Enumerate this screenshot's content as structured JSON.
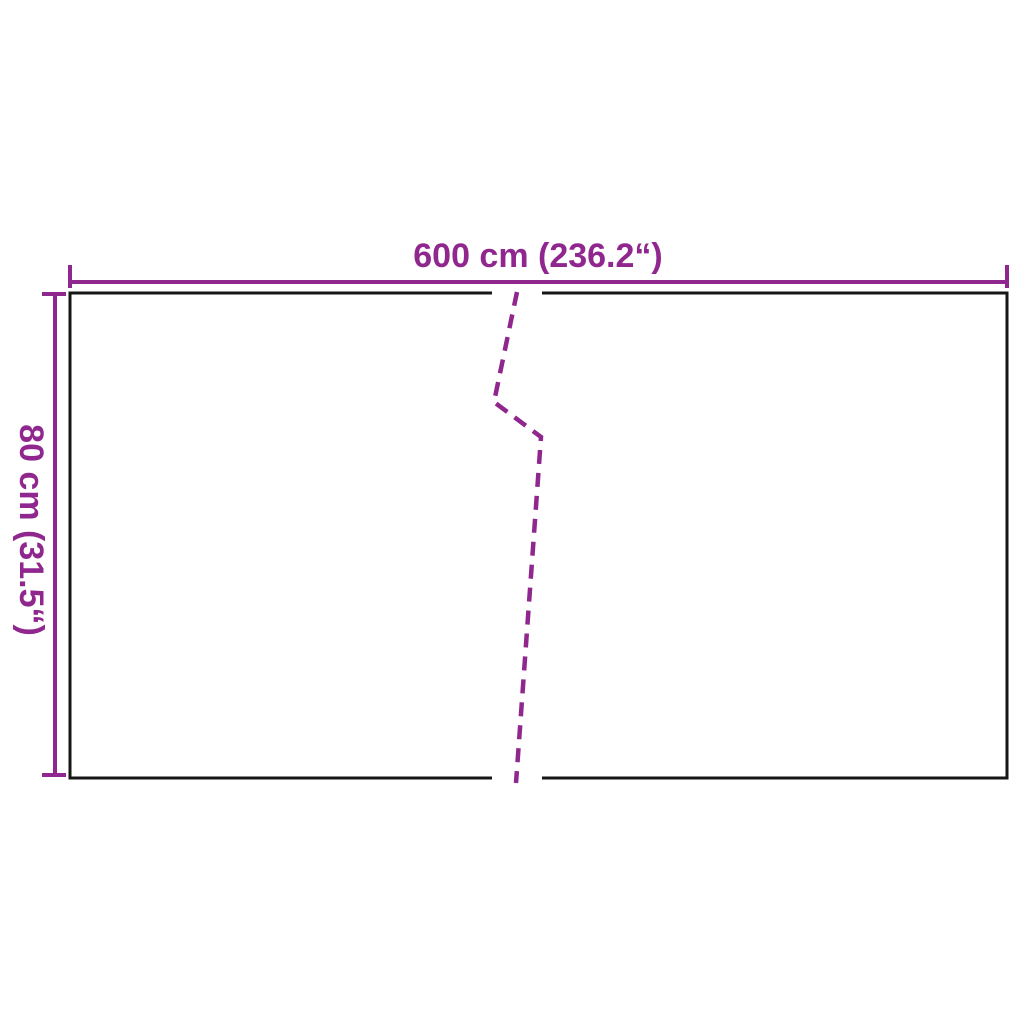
{
  "diagram": {
    "width_label": "600 cm (236.2“)",
    "height_label": "80 cm (31.5“)",
    "width_cm": 600,
    "width_inches": 236.2,
    "height_cm": 80,
    "height_inches": 31.5
  },
  "colors": {
    "dimension": "#90278E",
    "outline": "#161616",
    "background": "#FFFFFF"
  }
}
